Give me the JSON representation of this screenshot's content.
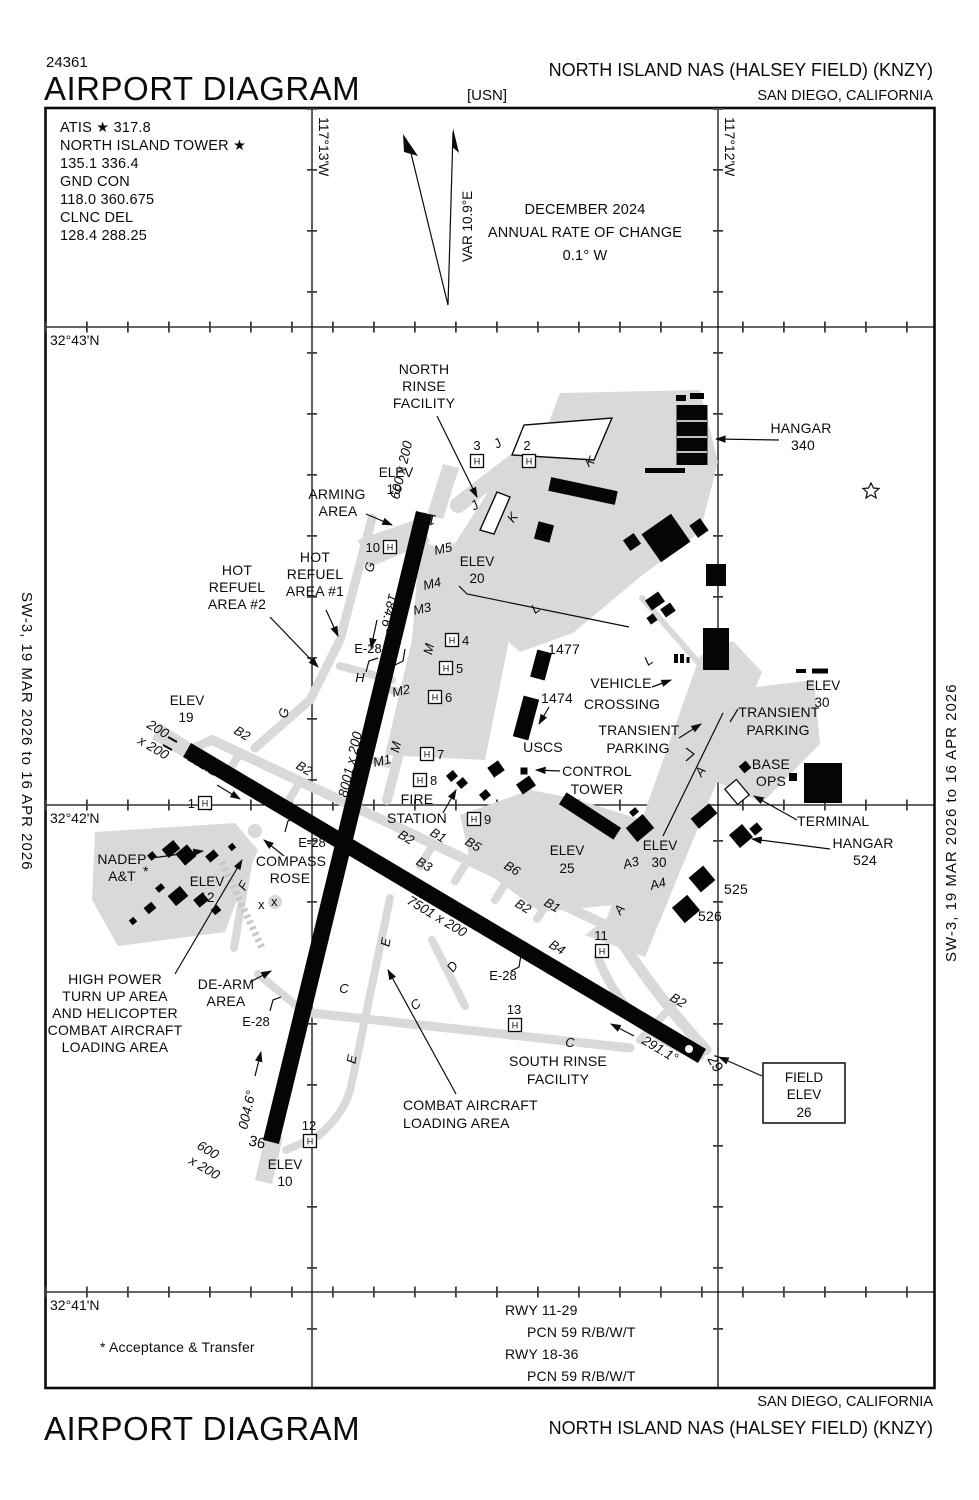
{
  "header": {
    "stock": "24361",
    "title": "AIRPORT DIAGRAM",
    "org": "[USN]",
    "airport": "NORTH ISLAND NAS (HALSEY FIELD)   (KNZY)",
    "city": "SAN DIEGO, CALIFORNIA"
  },
  "footer": {
    "title": "AIRPORT DIAGRAM",
    "city": "SAN DIEGO, CALIFORNIA",
    "airport": "NORTH ISLAND NAS (HALSEY FIELD)   (KNZY)"
  },
  "edges": {
    "left": "SW-3,  19 MAR 2026  to  16 APR 2026",
    "right": "SW-3,  19 MAR 2026  to  16 APR 2026"
  },
  "comms": {
    "l1": "ATIS ★  317.8",
    "l2": "NORTH ISLAND TOWER ★",
    "l3": "135.1  336.4",
    "l4": "GND CON",
    "l5": "118.0  360.675",
    "l6": "CLNC DEL",
    "l7": "128.4  288.25"
  },
  "variation": {
    "var": "VAR 10.9°E",
    "date": "DECEMBER 2024",
    "roc": "ANNUAL RATE OF CHANGE",
    "value": "0.1° W"
  },
  "graticule": {
    "lat43": "32°43'N",
    "lat42": "32°42'N",
    "lat41": "32°41'N",
    "lon13": "117°13'W",
    "lon12": "117°12'W"
  },
  "notes": {
    "acceptance": "* Acceptance & Transfer",
    "asterisk": "*"
  },
  "pcn": {
    "r1": "RWY 11-29",
    "p1": "PCN 59 R/B/W/T",
    "r2": "RWY 18-36",
    "p2": "PCN 59 R/B/W/T"
  },
  "runways": {
    "r1836": {
      "dim": "8001 x 200",
      "n": "18",
      "s": "36",
      "hn": "184.6°",
      "hs": "004.6°",
      "ovr_n": "600 x 200",
      "ovr_s1": "600",
      "ovr_s2": "x 200"
    },
    "r1129": {
      "dim": "7501 x 200",
      "e": "29",
      "hw": "111.1°",
      "he": "291.1°",
      "ovr_w1": "200",
      "ovr_w2": "x 200"
    }
  },
  "elev": {
    "label": "ELEV",
    "v10": "10",
    "v12": "12",
    "v19": "19",
    "v20": "20",
    "v25": "25",
    "v30": "30"
  },
  "field_elev": {
    "l1": "FIELD",
    "l2": "ELEV",
    "l3": "26"
  },
  "areas": {
    "north_rinse": [
      "NORTH",
      "RINSE",
      "FACILITY"
    ],
    "arming": [
      "ARMING",
      "AREA"
    ],
    "hot_refuel1": [
      "HOT",
      "REFUEL",
      "AREA #1"
    ],
    "hot_refuel2": [
      "HOT",
      "REFUEL",
      "AREA #2"
    ],
    "high_power": [
      "HIGH POWER",
      "TURN UP AREA",
      "AND HELICOPTER",
      "COMBAT AIRCRAFT",
      "LOADING AREA"
    ],
    "de_arm": [
      "DE-ARM",
      "AREA"
    ],
    "combat_loading": [
      "COMBAT AIRCRAFT",
      "LOADING AREA"
    ],
    "south_rinse": [
      "SOUTH RINSE",
      "FACILITY"
    ],
    "compass_rose": [
      "COMPASS",
      "ROSE"
    ],
    "nadep": [
      "NADEP",
      "A&T"
    ],
    "vehicle_crossing": [
      "VEHICLE",
      "CROSSING"
    ],
    "transient_parking": [
      "TRANSIENT",
      "PARKING"
    ],
    "base_ops": [
      "BASE",
      "OPS"
    ],
    "terminal": "TERMINAL",
    "hangar340": [
      "HANGAR",
      "340"
    ],
    "hangar524": [
      "HANGAR",
      "524"
    ],
    "control_tower": [
      "CONTROL",
      "TOWER"
    ],
    "uscs": "USCS",
    "fire_station": [
      "FIRE",
      "STATION"
    ]
  },
  "buildings": {
    "b1477": "1477",
    "b1474": "1474",
    "b525": "525",
    "b526": "526"
  },
  "arresting": {
    "label": "E-28"
  },
  "taxiways": {
    "a": "A",
    "a3": "A3",
    "a4": "A4",
    "b1": "B1",
    "b2": "B2",
    "b3": "B3",
    "b4": "B4",
    "b5": "B5",
    "b6": "B6",
    "c": "C",
    "d": "D",
    "e": "E",
    "f": "F",
    "g": "G",
    "h": "H",
    "j": "J",
    "k": "K",
    "l": "L",
    "m": "M",
    "m1": "M1",
    "m2": "M2",
    "m3": "M3",
    "m4": "M4",
    "m5": "M5"
  },
  "helipads": {
    "symbol": "H",
    "n1": "1",
    "n2": "2",
    "n3": "3",
    "n4": "4",
    "n5": "5",
    "n6": "6",
    "n7": "7",
    "n8": "8",
    "n9": "9",
    "n10": "10",
    "n11": "11",
    "n12": "12",
    "n13": "13"
  },
  "compass": {
    "x_mark": "x"
  }
}
